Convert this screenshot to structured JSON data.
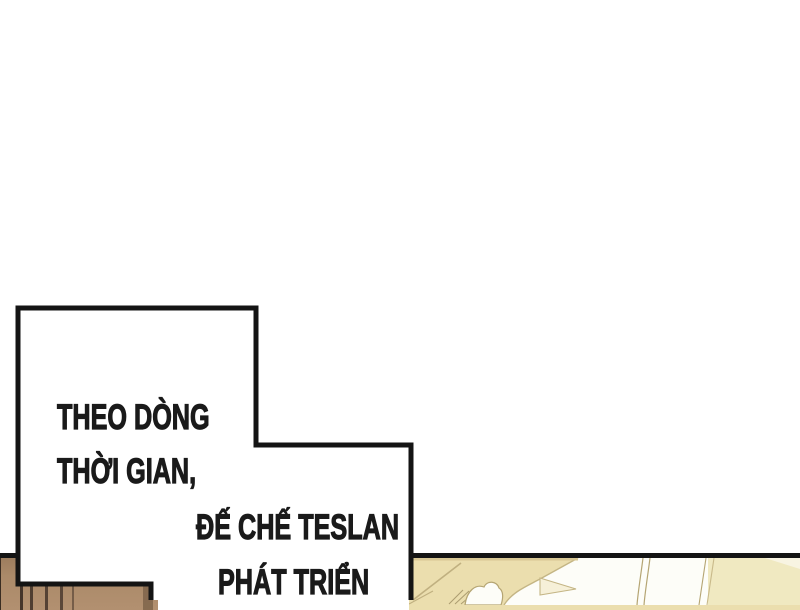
{
  "caption": {
    "lines": [
      "THEO DÒNG",
      "THỜI GIAN,",
      "ĐẾ CHẾ TESLAN",
      "PHÁT TRIỂN"
    ]
  },
  "colors": {
    "page_background": "#ffffff",
    "caption_box_fill": "#ffffff",
    "caption_box_border": "#141414",
    "caption_text": "#1a1a1a",
    "panel_border": "#141414",
    "left_panel_wood": "#ab8a69",
    "left_panel_plank_line": "#45352a",
    "right_panel_floor": "#ebdeae",
    "right_panel_cream": "#f0e9c1",
    "right_panel_outline": "#b5a573",
    "right_panel_white": "#fdfdf8"
  },
  "panels": {
    "bottom_left": {
      "content": "wooden planks artwork"
    },
    "bottom_right": {
      "content": "pale interior artwork with white shapes"
    }
  }
}
